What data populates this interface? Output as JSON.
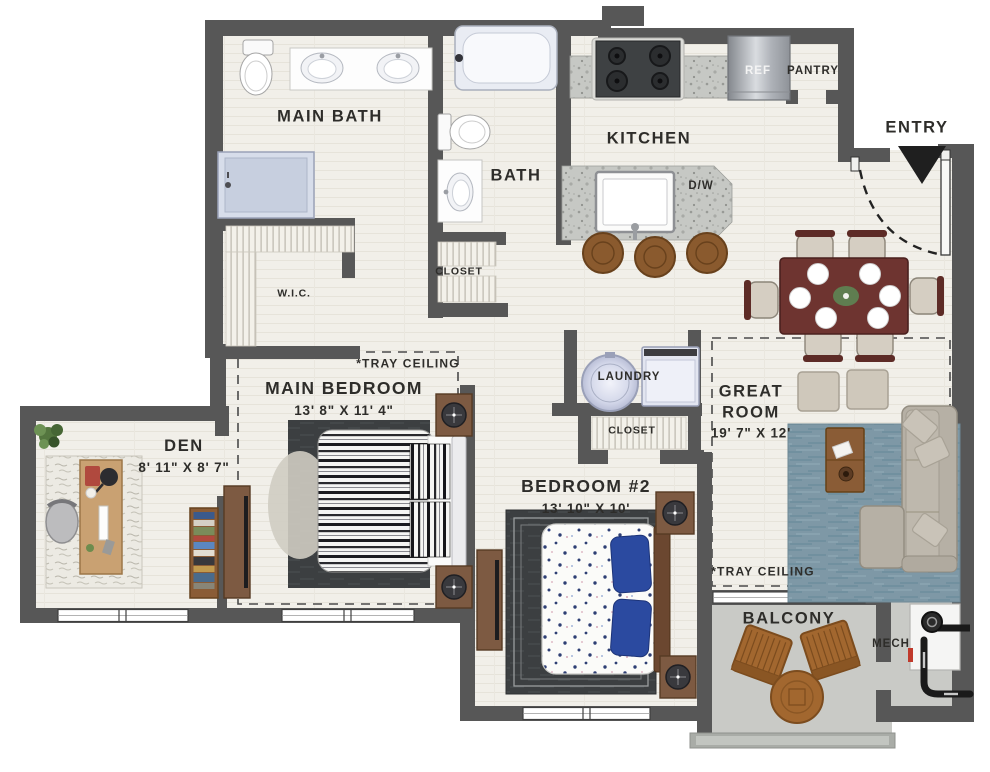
{
  "plan_type": "apartment-floor-plan",
  "colors": {
    "wall": "#575757",
    "floor": "#f1efe9",
    "granite": "#c6c8c4",
    "balcony_floor": "#c9cac6",
    "rug_blue": "#7e98a6",
    "rug_dark": "#3c3f41",
    "wood_furniture": "#7d5a42",
    "dining_wood": "#6e3430",
    "accent_navy": "#2b4aa0",
    "label_text": "#2e2d2a"
  },
  "rooms": {
    "main_bath": {
      "label": "MAIN BATH"
    },
    "bath": {
      "label": "BATH"
    },
    "kitchen": {
      "label": "KITCHEN"
    },
    "pantry": {
      "label": "PANTRY"
    },
    "refrigerator": {
      "label": "REF"
    },
    "dishwasher": {
      "label": "D/W"
    },
    "entry": {
      "label": "ENTRY"
    },
    "walk_in_closet": {
      "label": "W.I.C."
    },
    "bath_closet": {
      "label": "CLOSET"
    },
    "laundry": {
      "label": "LAUNDRY"
    },
    "hall_closet": {
      "label": "CLOSET"
    },
    "great_room": {
      "label": "GREAT ROOM",
      "dimensions": "19' 7\" X 12'"
    },
    "main_bedroom": {
      "label": "MAIN BEDROOM",
      "dimensions": "13' 8\" X 11' 4\""
    },
    "bedroom_2": {
      "label": "BEDROOM #2",
      "dimensions": "13' 10\" X 10'"
    },
    "den": {
      "label": "DEN",
      "dimensions": "8' 11\" X 8' 7\""
    },
    "balcony": {
      "label": "BALCONY"
    },
    "mech": {
      "label": "MECH"
    }
  },
  "annotations": {
    "tray_ceiling_main_bedroom": "*TRAY CEILING",
    "tray_ceiling_great_room": "*TRAY CEILING"
  }
}
